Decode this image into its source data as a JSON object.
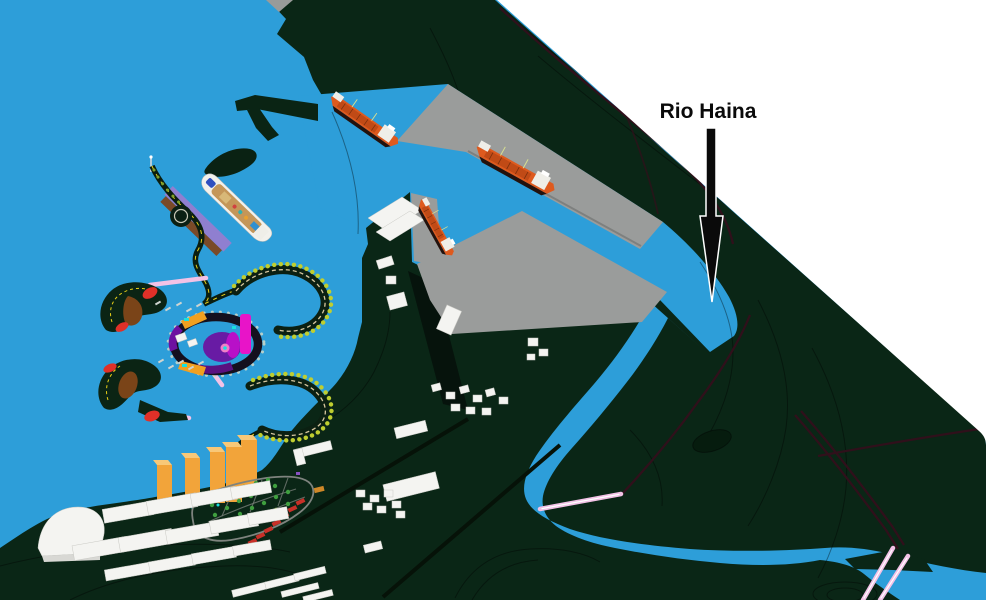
{
  "annotation": {
    "label": "Rio Haina"
  },
  "features": {
    "cargo_ships": 3,
    "cruise_ships": 1,
    "bridges": 2,
    "orange_towers": 5
  },
  "colors": {
    "water": "#2D9ED9",
    "land": "#0A2616",
    "background_white": "#FFFFFF",
    "pier_gray": "#9A9C9B",
    "contour": "#03140B",
    "road_dark": "#30101B",
    "building_white": "#F4F4F1",
    "tower_orange": "#F2A43A",
    "ship_hull": "#DE5A1E",
    "ship_deck": "#C04A16",
    "ship_white": "#EFEEE8",
    "cruise_deck_tan": "#C49659",
    "cruise_pier_purple": "#8F7FD0",
    "boardwalk_brown": "#7A4A28",
    "palm_green": "#BFCE30",
    "road_stripe_yellow": "#E8D018",
    "resort_red": "#E03028",
    "resort_brown": "#7A4418",
    "resort_magenta": "#E814C8",
    "resort_purple": "#6E10A0",
    "resort_orange": "#F0A020",
    "resort_cyan": "#18E0E0",
    "bridge_pink": "#F2C2E6",
    "label_color": "#0A0A0A"
  }
}
